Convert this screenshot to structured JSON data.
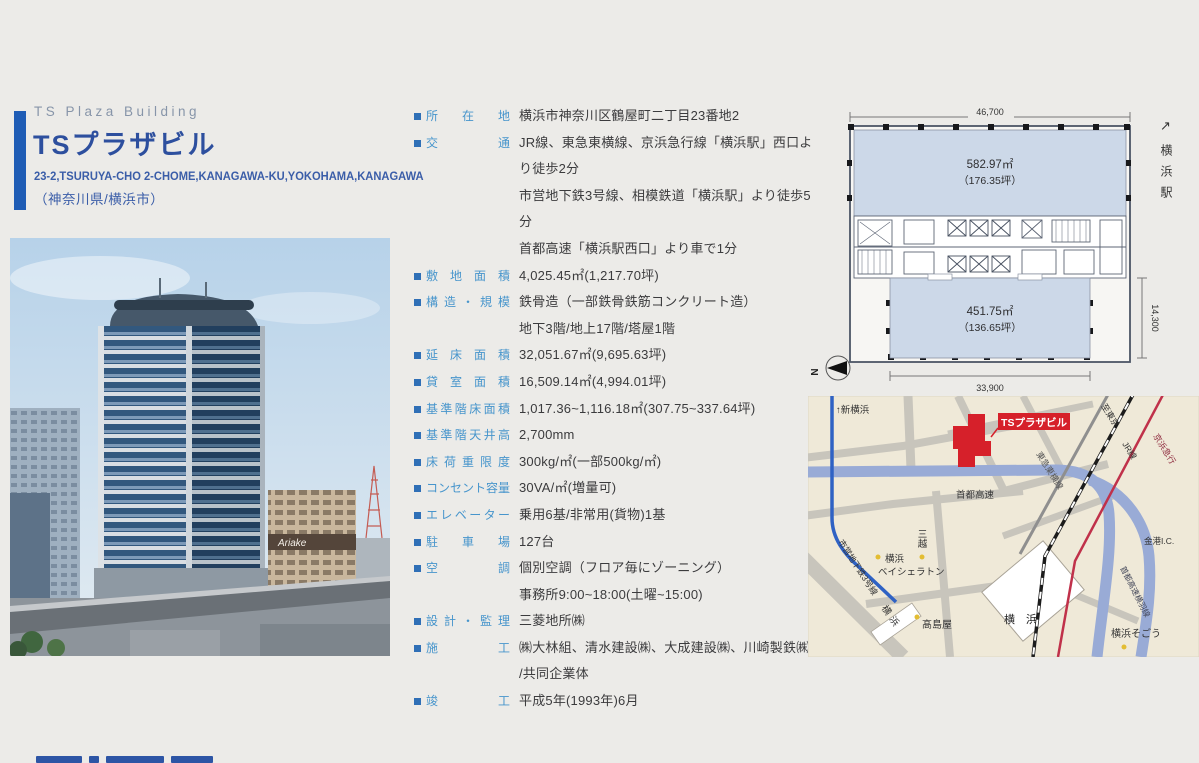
{
  "header": {
    "title_en": "TS Plaza Building",
    "title_ja": "TSプラザビル",
    "address_en": "23-2,TSURUYA-CHO 2-CHOME,KANAGAWA-KU,YOKOHAMA,KANAGAWA",
    "region_ja": "（神奈川県/横浜市）"
  },
  "photo": {
    "sign": "Ariake"
  },
  "specs": {
    "rows": [
      {
        "label": "所在地",
        "value": "横浜市神奈川区鶴屋町二丁目23番地2"
      },
      {
        "label": "交通",
        "value": "JR線、東急東横線、京浜急行線「横浜駅」西口より徒歩2分\n市営地下鉄3号線、相模鉄道「横浜駅」より徒歩5分\n首都高速「横浜駅西口」より車で1分"
      },
      {
        "label": "敷地面積",
        "value": "4,025.45㎡(1,217.70坪)"
      },
      {
        "label": "構造・規模",
        "value": "鉄骨造（一部鉄骨鉄筋コンクリート造）\n地下3階/地上17階/塔屋1階"
      },
      {
        "label": "延床面積",
        "value": "32,051.67㎡(9,695.63坪)"
      },
      {
        "label": "貸室面積",
        "value": "16,509.14㎡(4,994.01坪)"
      },
      {
        "label": "基準階床面積",
        "value": "1,017.36~1,116.18㎡(307.75~337.64坪)"
      },
      {
        "label": "基準階天井高",
        "value": "2,700mm"
      },
      {
        "label": "床荷重限度",
        "value": "300kg/㎡(一部500kg/㎡)"
      },
      {
        "label": "コンセント容量",
        "value": "30VA/㎡(増量可)"
      },
      {
        "label": "エレベーター",
        "value": "乗用6基/非常用(貨物)1基"
      },
      {
        "label": "駐車場",
        "value": "127台"
      },
      {
        "label": "空調",
        "value": "個別空調（フロア毎にゾーニング）\n事務所9:00~18:00(土曜~15:00)"
      },
      {
        "label": "設計・監理",
        "value": "三菱地所㈱"
      },
      {
        "label": "施工",
        "value": "㈱大林組、清水建設㈱、大成建設㈱、川崎製鉄㈱\n/共同企業体"
      },
      {
        "label": "竣工",
        "value": "平成5年(1993年)6月"
      }
    ]
  },
  "floorplan": {
    "dim_width_top": "46,700",
    "dim_width_bottom": "33,900",
    "dim_depth_right": "14,300",
    "upper_area": "582.97㎡",
    "upper_tsubo": "（176.35坪）",
    "lower_area": "451.75㎡",
    "lower_tsubo": "（136.65坪）",
    "north_label": "N",
    "direction_arrow": "↗",
    "direction_station": "横浜駅"
  },
  "map": {
    "building_label": "TSプラザビル",
    "to_shin_yokohama": "↑新横浜",
    "expressway": "首都高速",
    "expressway_branch": "首都高速横羽線",
    "kinko_ic": "金港I.C.",
    "mitsukoshi": "三越",
    "sheraton_line1": "横浜",
    "sheraton_line2": "ベイシェラトン",
    "takashimaya": "髙島屋",
    "sogo": "横浜そごう",
    "station_main": "横　浜",
    "station_west": "横浜",
    "subway_line": "市営地下鉄3号線",
    "rail_tokyu": "東急東横線",
    "rail_jr_dir": "至東京",
    "rail_jr": "JR線",
    "rail_keikyu": "京浜急行"
  }
}
